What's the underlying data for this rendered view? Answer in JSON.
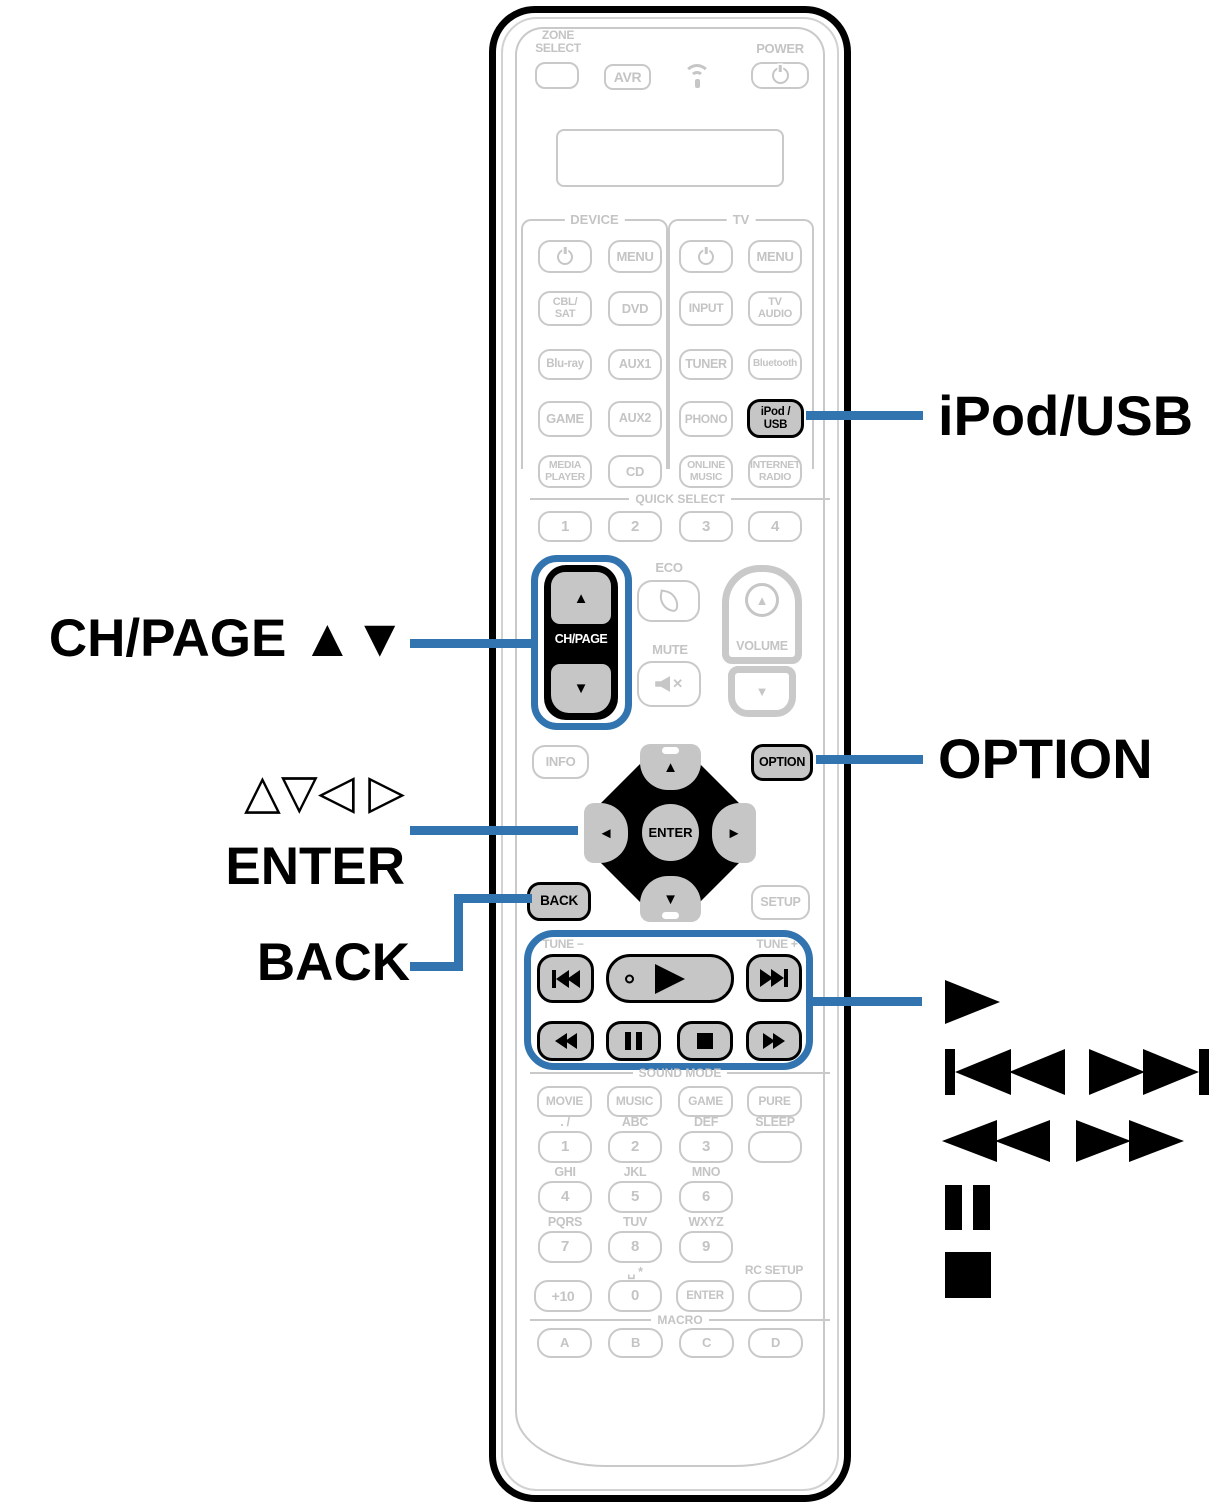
{
  "colors": {
    "accent_blue": "#3274b0",
    "button_outline_gray": "#c9c9c9",
    "button_text_gray": "#c4c4c4",
    "highlight_fill_gray": "#c6c6c6",
    "black": "#000000"
  },
  "callouts": {
    "left": {
      "ch_page": "CH/PAGE ▲▼",
      "cursor_triangles": "△▽◁ ▷",
      "enter": "ENTER",
      "back": "BACK"
    },
    "right": {
      "ipod_usb": "iPod/USB",
      "option": "OPTION",
      "play_icon_name": "play-icon",
      "skip_icons_name": "skip-back-and-skip-forward-icons",
      "seek_icons_name": "rewind-and-fast-forward-icons",
      "pause_icon_name": "pause-icon",
      "stop_icon_name": "stop-icon"
    }
  },
  "remote": {
    "header": {
      "zone_select": "ZONE\nSELECT",
      "avr": "AVR",
      "power": "POWER"
    },
    "sections": {
      "device": "DEVICE",
      "tv": "TV",
      "quick_select": "QUICK SELECT",
      "sound_mode": "SOUND MODE",
      "macro": "MACRO",
      "eco": "ECO",
      "mute": "MUTE",
      "volume": "VOLUME",
      "tune_minus": "TUNE −",
      "tune_plus": "TUNE +",
      "sleep": "SLEEP",
      "rc_setup": "RC SETUP",
      "space_star": "␣ *"
    },
    "buttons": {
      "device_menu": "MENU",
      "tv_menu": "MENU",
      "info": "INFO",
      "option": "OPTION",
      "back": "BACK",
      "setup": "SETUP",
      "enter": "ENTER",
      "plus10": "+10",
      "zero": "0",
      "enter_num": "ENTER"
    },
    "rows1": [
      "CBL/\nSAT",
      "DVD",
      "INPUT",
      "TV\nAUDIO"
    ],
    "rows2": [
      "Blu-ray",
      "AUX1",
      "TUNER",
      "Bluetooth"
    ],
    "rows3": [
      "GAME",
      "AUX2",
      "PHONO",
      "iPod /\nUSB"
    ],
    "rows4": [
      "MEDIA\nPLAYER",
      "CD",
      "ONLINE\nMUSIC",
      "INTERNET\nRADIO"
    ],
    "quick": [
      "1",
      "2",
      "3",
      "4"
    ],
    "sound": [
      "MOVIE",
      "MUSIC",
      "GAME",
      "PURE"
    ],
    "keypad_letters": [
      ". /",
      "ABC",
      "DEF",
      "GHI",
      "JKL",
      "MNO",
      "PQRS",
      "TUV",
      "WXYZ"
    ],
    "digits": [
      "1",
      "2",
      "3",
      "4",
      "5",
      "6",
      "7",
      "8",
      "9"
    ],
    "macro_keys": [
      "A",
      "B",
      "C",
      "D"
    ],
    "ch_page": {
      "label": "CH/PAGE",
      "up": "▲",
      "down": "▼"
    },
    "cursor": {
      "up": "▲",
      "down": "▼",
      "left": "◄",
      "right": "►"
    },
    "volume": {
      "up": "▲",
      "down": "▼"
    }
  }
}
